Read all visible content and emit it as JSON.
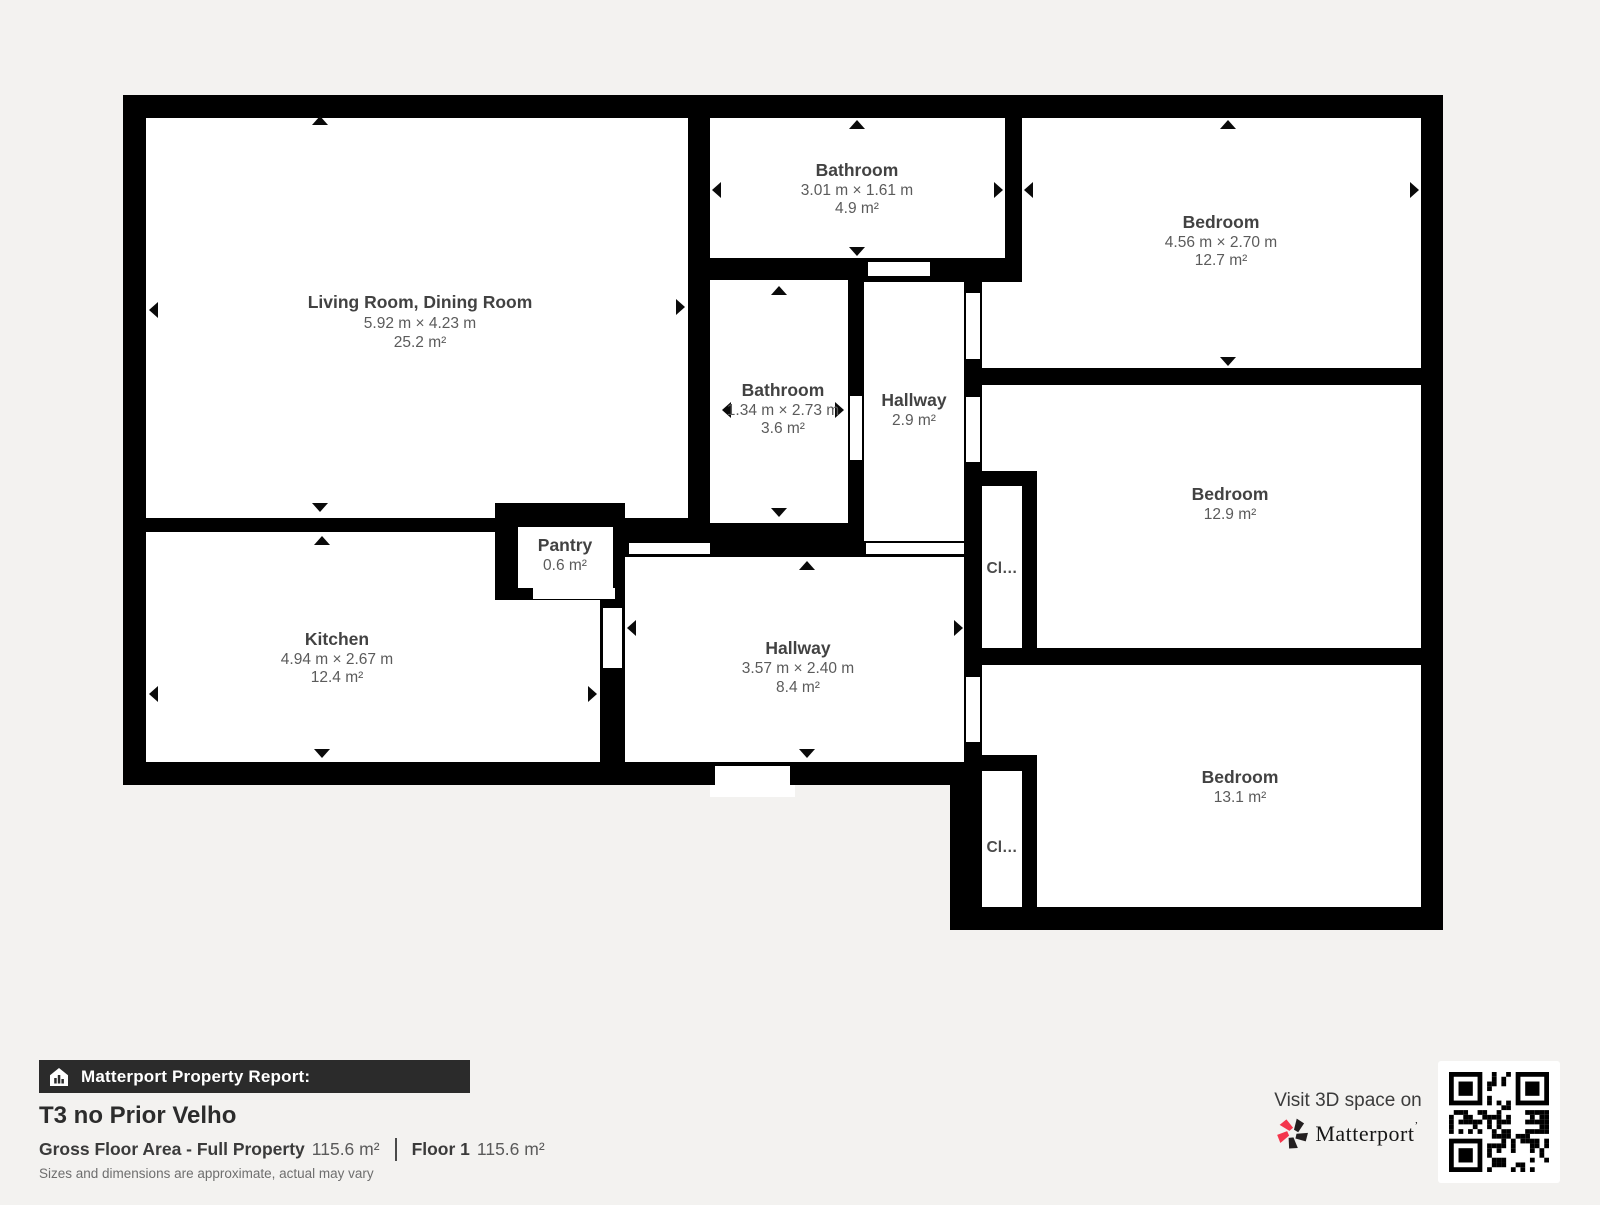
{
  "colors": {
    "background": "#f3f2f0",
    "wall": "#000000",
    "brand_pink": "#f4364c",
    "bar_bg": "#2b2b2b"
  },
  "rooms": [
    {
      "id": "living-dining",
      "name": "Living Room, Dining Room",
      "dims": "5.92 m × 4.23 m",
      "area": "25.2 m²"
    },
    {
      "id": "bathroom-top",
      "name": "Bathroom",
      "dims": "3.01 m × 1.61 m",
      "area": "4.9 m²"
    },
    {
      "id": "bedroom-top-right",
      "name": "Bedroom",
      "dims": "4.56 m × 2.70 m",
      "area": "12.7 m²"
    },
    {
      "id": "bathroom-middle",
      "name": "Bathroom",
      "dims": "1.34 m × 2.73 m",
      "area": "3.6 m²"
    },
    {
      "id": "hallway-small",
      "name": "Hallway",
      "area": "2.9 m²"
    },
    {
      "id": "bedroom-middle-right",
      "name": "Bedroom",
      "area": "12.9 m²"
    },
    {
      "id": "kitchen",
      "name": "Kitchen",
      "dims": "4.94 m × 2.67 m",
      "area": "12.4 m²"
    },
    {
      "id": "pantry",
      "name": "Pantry",
      "area": "0.6 m²"
    },
    {
      "id": "hallway-main",
      "name": "Hallway",
      "dims": "3.57 m × 2.40 m",
      "area": "8.4 m²"
    },
    {
      "id": "bedroom-bottom-right",
      "name": "Bedroom",
      "area": "13.1 m²"
    },
    {
      "id": "closet-upper",
      "name": "Cl…"
    },
    {
      "id": "closet-lower",
      "name": "Cl…"
    }
  ],
  "footer": {
    "report_label": "Matterport Property Report:",
    "property_title": "T3 no Prior Velho",
    "gross_label": "Gross Floor Area - Full Property",
    "gross_value": "115.6 m²",
    "floor_label": "Floor 1",
    "floor_value": "115.6 m²",
    "disclaimer": "Sizes and dimensions are approximate, actual may vary",
    "visit_text": "Visit 3D space on",
    "brand": "Matterport",
    "brand_mark": "ʼ"
  }
}
